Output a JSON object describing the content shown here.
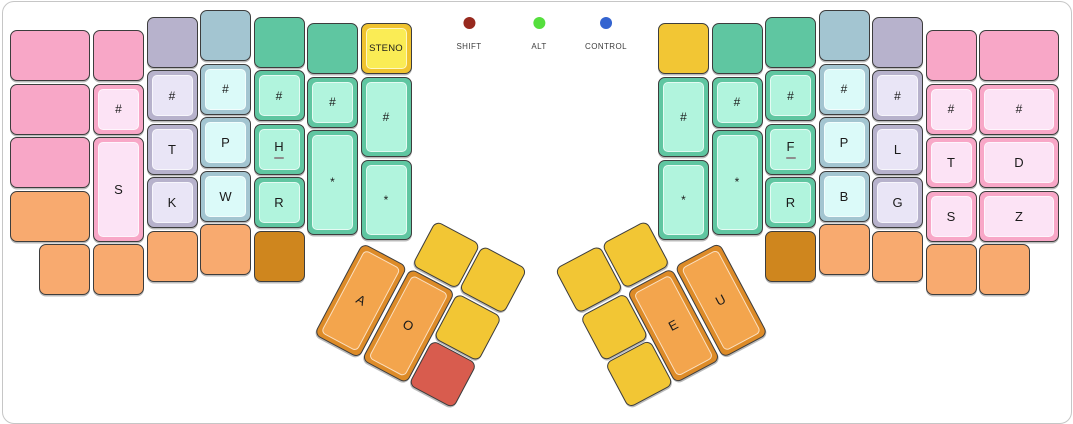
{
  "panel": {
    "background": "#ffffff",
    "border_color": "#c6c6c6"
  },
  "indicators": [
    {
      "id": "shift",
      "label": "SHIFT",
      "color": "#97291E"
    },
    {
      "id": "alt",
      "label": "ALT",
      "color": "#55DF3D"
    },
    {
      "id": "control",
      "label": "CONTROL",
      "color": "#3464D0"
    }
  ],
  "keyboard": {
    "unit_px": 53.5,
    "key_px": 51,
    "palette": {
      "pink": {
        "base": "#F8A7C7",
        "inner": "#FCE3F5"
      },
      "lavender": {
        "base": "#B7B2CC",
        "inner": "#E9E5F6"
      },
      "bluegray": {
        "base": "#A3C5D1",
        "inner": "#DBFAF9"
      },
      "green": {
        "base": "#5FC6A1",
        "inner": "#B1F4DD"
      },
      "yellow": {
        "base": "#F2C634"
      },
      "steno": {
        "base": "#F0C32F",
        "inner": "#FAEC55"
      },
      "orange": {
        "base": "#F8AA6F"
      },
      "darkorange": {
        "base": "#CF861E"
      },
      "thumborange": {
        "base": "#DD8B28",
        "inner": "#F3A54D"
      },
      "red": {
        "base": "#D85C4E"
      }
    },
    "thumb_clusters": {
      "left": {
        "x": 388,
        "y": 195,
        "angle_deg": 28
      },
      "right": {
        "x": 532.5,
        "y": 195,
        "angle_deg": -28
      }
    },
    "keys": [
      {
        "id": "l1-row1",
        "label": "",
        "color": "pink",
        "x": 10,
        "y": 30,
        "w": 80
      },
      {
        "id": "l1-row2",
        "label": "",
        "color": "pink",
        "x": 10,
        "y": 83.5,
        "w": 80
      },
      {
        "id": "l1-row3",
        "label": "",
        "color": "pink",
        "x": 10,
        "y": 137,
        "w": 80
      },
      {
        "id": "l1-row4",
        "label": "",
        "color": "orange",
        "x": 10,
        "y": 190.5,
        "w": 80
      },
      {
        "id": "l1-bottom",
        "label": "",
        "color": "orange",
        "x": 39,
        "y": 244
      },
      {
        "id": "l2-row1",
        "label": "",
        "color": "pink",
        "x": 93,
        "y": 30
      },
      {
        "id": "l2-hash",
        "label": "#",
        "color": "pink",
        "inset": true,
        "x": 93,
        "y": 83.5
      },
      {
        "id": "s-left",
        "label": "S",
        "color": "pink",
        "inset": true,
        "x": 93,
        "y": 137,
        "h": 104.5
      },
      {
        "id": "l2-bottom",
        "label": "",
        "color": "orange",
        "x": 93,
        "y": 244
      },
      {
        "id": "l3-row1",
        "label": "",
        "color": "lavender",
        "x": 146.5,
        "y": 16.5
      },
      {
        "id": "l3-hash",
        "label": "#",
        "color": "lavender",
        "inset": true,
        "x": 146.5,
        "y": 70
      },
      {
        "id": "t-left",
        "label": "T",
        "color": "lavender",
        "inset": true,
        "x": 146.5,
        "y": 123.5
      },
      {
        "id": "k-left",
        "label": "K",
        "color": "lavender",
        "inset": true,
        "x": 146.5,
        "y": 177
      },
      {
        "id": "l3-bottom",
        "label": "",
        "color": "orange",
        "x": 146.5,
        "y": 230.5
      },
      {
        "id": "l4-row1",
        "label": "",
        "color": "bluegray",
        "x": 200,
        "y": 10
      },
      {
        "id": "l4-hash",
        "label": "#",
        "color": "bluegray",
        "inset": true,
        "x": 200,
        "y": 63.5
      },
      {
        "id": "p-left",
        "label": "P",
        "color": "bluegray",
        "inset": true,
        "x": 200,
        "y": 117
      },
      {
        "id": "w-left",
        "label": "W",
        "color": "bluegray",
        "inset": true,
        "x": 200,
        "y": 170.5
      },
      {
        "id": "l4-bottom",
        "label": "",
        "color": "orange",
        "x": 200,
        "y": 224
      },
      {
        "id": "l5-row1",
        "label": "",
        "color": "green",
        "x": 253.5,
        "y": 16.5
      },
      {
        "id": "l5-hash",
        "label": "#",
        "color": "green",
        "inset": true,
        "x": 253.5,
        "y": 70
      },
      {
        "id": "h-left",
        "label": "H",
        "underline": true,
        "color": "green",
        "inset": true,
        "x": 253.5,
        "y": 123.5
      },
      {
        "id": "r-left",
        "label": "R",
        "color": "green",
        "inset": true,
        "x": 253.5,
        "y": 177
      },
      {
        "id": "l5-bottom",
        "label": "",
        "color": "darkorange",
        "x": 253.5,
        "y": 230.5
      },
      {
        "id": "l6-row1",
        "label": "",
        "color": "green",
        "x": 307,
        "y": 23
      },
      {
        "id": "l6-hash",
        "label": "#",
        "color": "green",
        "inset": true,
        "x": 307,
        "y": 76.5
      },
      {
        "id": "star-left-outer",
        "label": "*",
        "color": "green",
        "inset": true,
        "x": 307,
        "y": 130,
        "h": 104.5
      },
      {
        "id": "steno-mode",
        "label": "STENO",
        "color": "steno",
        "inset": true,
        "x": 360.5,
        "y": 23
      },
      {
        "id": "l7-hash",
        "label": "#",
        "color": "green",
        "inset": true,
        "x": 360.5,
        "y": 76.5,
        "h": 80
      },
      {
        "id": "star-left-inner",
        "label": "*",
        "color": "green",
        "inset": true,
        "x": 360.5,
        "y": 159.5,
        "h": 80
      },
      {
        "id": "r1-row1",
        "label": "",
        "color": "yellow",
        "x": 658,
        "y": 23
      },
      {
        "id": "r1-hash",
        "label": "#",
        "color": "green",
        "inset": true,
        "x": 658,
        "y": 76.5,
        "h": 80
      },
      {
        "id": "star-right-inner",
        "label": "*",
        "color": "green",
        "inset": true,
        "x": 658,
        "y": 159.5,
        "h": 80
      },
      {
        "id": "r2-row1",
        "label": "",
        "color": "green",
        "x": 711.5,
        "y": 23
      },
      {
        "id": "r2-hash",
        "label": "#",
        "color": "green",
        "inset": true,
        "x": 711.5,
        "y": 76.5
      },
      {
        "id": "star-right-outer",
        "label": "*",
        "color": "green",
        "inset": true,
        "x": 711.5,
        "y": 130,
        "h": 104.5
      },
      {
        "id": "r3-row1",
        "label": "",
        "color": "green",
        "x": 765,
        "y": 16.5
      },
      {
        "id": "r3-hash",
        "label": "#",
        "color": "green",
        "inset": true,
        "x": 765,
        "y": 70
      },
      {
        "id": "f-right",
        "label": "F",
        "underline": true,
        "color": "green",
        "inset": true,
        "x": 765,
        "y": 123.5
      },
      {
        "id": "r-right",
        "label": "R",
        "color": "green",
        "inset": true,
        "x": 765,
        "y": 177
      },
      {
        "id": "r3-bottom",
        "label": "",
        "color": "darkorange",
        "x": 765,
        "y": 230.5
      },
      {
        "id": "r4-row1",
        "label": "",
        "color": "bluegray",
        "x": 818.5,
        "y": 10
      },
      {
        "id": "r4-hash",
        "label": "#",
        "color": "bluegray",
        "inset": true,
        "x": 818.5,
        "y": 63.5
      },
      {
        "id": "p-right",
        "label": "P",
        "color": "bluegray",
        "inset": true,
        "x": 818.5,
        "y": 117
      },
      {
        "id": "b-right",
        "label": "B",
        "color": "bluegray",
        "inset": true,
        "x": 818.5,
        "y": 170.5
      },
      {
        "id": "r4-bottom",
        "label": "",
        "color": "orange",
        "x": 818.5,
        "y": 224
      },
      {
        "id": "r5-row1",
        "label": "",
        "color": "lavender",
        "x": 872,
        "y": 16.5
      },
      {
        "id": "r5-hash",
        "label": "#",
        "color": "lavender",
        "inset": true,
        "x": 872,
        "y": 70
      },
      {
        "id": "l-right",
        "label": "L",
        "color": "lavender",
        "inset": true,
        "x": 872,
        "y": 123.5
      },
      {
        "id": "g-right",
        "label": "G",
        "color": "lavender",
        "inset": true,
        "x": 872,
        "y": 177
      },
      {
        "id": "r5-bottom",
        "label": "",
        "color": "orange",
        "x": 872,
        "y": 230.5
      },
      {
        "id": "r6-row1",
        "label": "",
        "color": "pink",
        "x": 925.5,
        "y": 30
      },
      {
        "id": "r6-hash",
        "label": "#",
        "color": "pink",
        "inset": true,
        "x": 925.5,
        "y": 83.5
      },
      {
        "id": "t-right",
        "label": "T",
        "color": "pink",
        "inset": true,
        "x": 925.5,
        "y": 137
      },
      {
        "id": "s-right",
        "label": "S",
        "color": "pink",
        "inset": true,
        "x": 925.5,
        "y": 190.5
      },
      {
        "id": "r6-bottom",
        "label": "",
        "color": "orange",
        "x": 925.5,
        "y": 244
      },
      {
        "id": "r7-row1",
        "label": "",
        "color": "pink",
        "x": 979,
        "y": 30,
        "w": 80
      },
      {
        "id": "r7-hash",
        "label": "#",
        "color": "pink",
        "inset": true,
        "x": 979,
        "y": 83.5,
        "w": 80
      },
      {
        "id": "d-right",
        "label": "D",
        "color": "pink",
        "inset": true,
        "x": 979,
        "y": 137,
        "w": 80
      },
      {
        "id": "z-right",
        "label": "Z",
        "color": "pink",
        "inset": true,
        "x": 979,
        "y": 190.5,
        "w": 80
      },
      {
        "id": "r7-bottom",
        "label": "",
        "color": "orange",
        "x": 979,
        "y": 244
      },
      {
        "id": "a-vowel",
        "label": "A",
        "color": "thumborange",
        "inset": true,
        "cluster": "left",
        "x": 0,
        "y": 53.5,
        "h": 104.5
      },
      {
        "id": "o-vowel",
        "label": "O",
        "color": "thumborange",
        "inset": true,
        "cluster": "left",
        "x": 53.5,
        "y": 53.5,
        "h": 104.5
      },
      {
        "id": "lthumb-top1",
        "label": "",
        "color": "yellow",
        "cluster": "left",
        "x": 53.5,
        "y": 0
      },
      {
        "id": "lthumb-top2",
        "label": "",
        "color": "yellow",
        "cluster": "left",
        "x": 107,
        "y": 0
      },
      {
        "id": "lthumb-mid",
        "label": "",
        "color": "yellow",
        "cluster": "left",
        "x": 107,
        "y": 53.5
      },
      {
        "id": "lthumb-red",
        "label": "",
        "color": "red",
        "cluster": "left",
        "x": 107,
        "y": 107
      },
      {
        "id": "e-vowel",
        "label": "E",
        "color": "thumborange",
        "inset": true,
        "cluster": "right",
        "x": 56,
        "y": 53.5,
        "h": 104.5
      },
      {
        "id": "u-vowel",
        "label": "U",
        "color": "thumborange",
        "inset": true,
        "cluster": "right",
        "x": 109.5,
        "y": 53.5,
        "h": 104.5
      },
      {
        "id": "rthumb-top1",
        "label": "",
        "color": "yellow",
        "cluster": "right",
        "x": 56,
        "y": 0
      },
      {
        "id": "rthumb-top2",
        "label": "",
        "color": "yellow",
        "cluster": "right",
        "x": 2.5,
        "y": 0
      },
      {
        "id": "rthumb-mid",
        "label": "",
        "color": "yellow",
        "cluster": "right",
        "x": 2.5,
        "y": 53.5
      },
      {
        "id": "rthumb-bottom",
        "label": "",
        "color": "yellow",
        "cluster": "right",
        "x": 2.5,
        "y": 107
      }
    ]
  }
}
